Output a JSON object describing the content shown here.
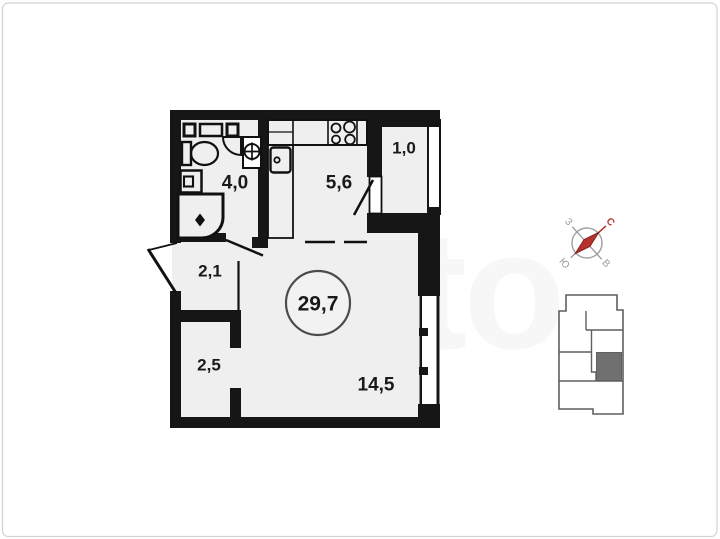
{
  "floorplan": {
    "total_area_label": "29,7",
    "room_labels": {
      "bathroom": "4,0",
      "kitchen": "5,6",
      "balcony": "1,0",
      "hallway": "2,1",
      "closet": "2,5",
      "living_room": "14,5"
    },
    "wall_color": "#161616",
    "floor_fill": "#efefef"
  },
  "compass": {
    "north_label": "С",
    "east_label": "В",
    "south_label": "Ю",
    "west_label": "З",
    "needle_color": "#b7322c",
    "label_color": "#9a9a9a",
    "rotation_deg": 48
  },
  "minimap": {
    "outline_color": "#5f5f5f",
    "unit_fill": "#707070"
  },
  "watermark": {
    "text": "Avito"
  }
}
